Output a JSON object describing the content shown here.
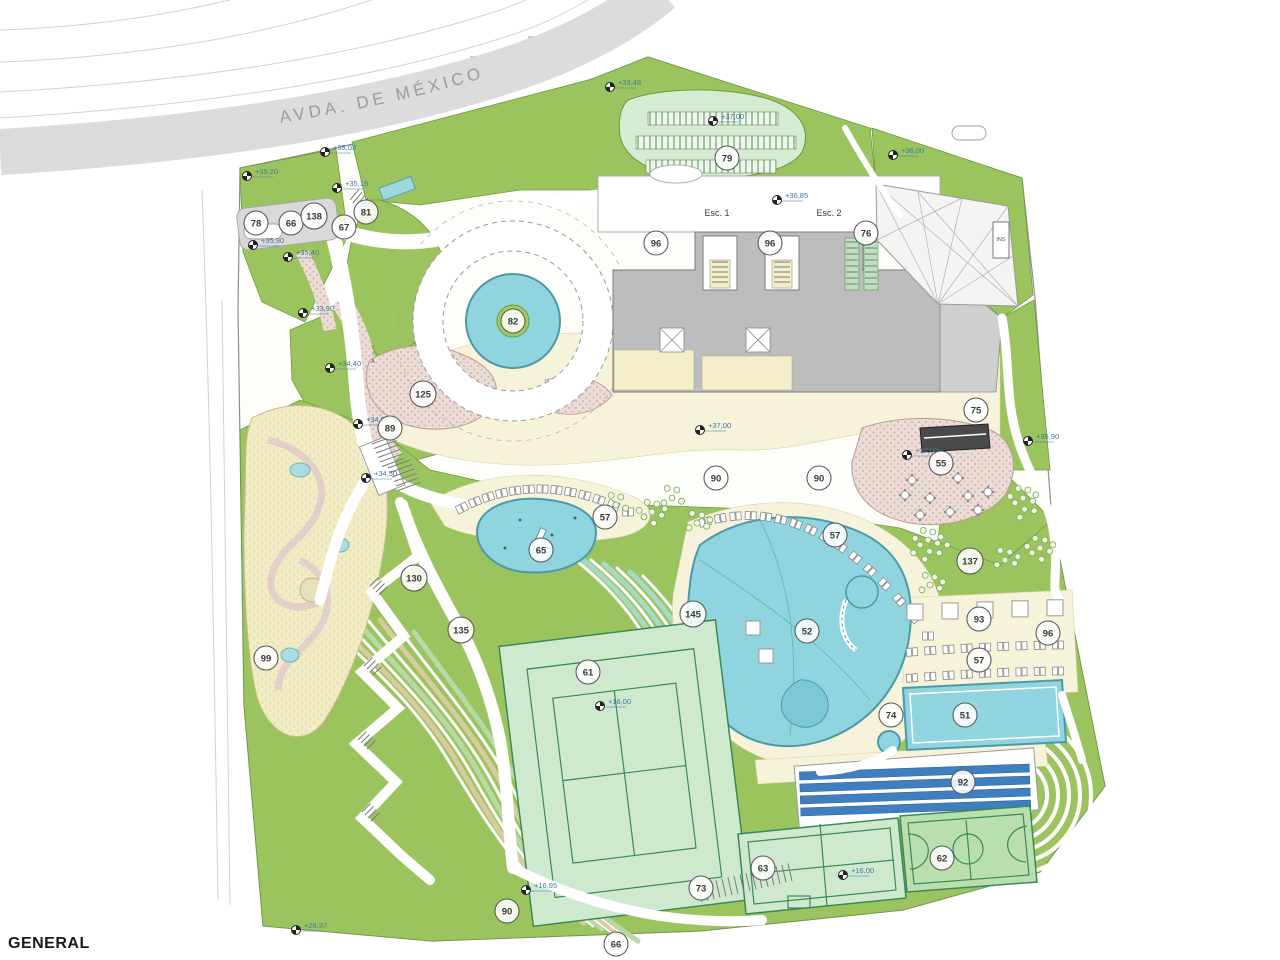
{
  "drawing": {
    "title": "GENERAL",
    "street_name": "AVDA. DE MÉXICO"
  },
  "colors": {
    "green": "#9cc45e",
    "mint": "#cfe9cf",
    "pool": "#8fd4de",
    "pool_edge": "#4a9aa8",
    "cream": "#f6f3da",
    "terrace_pink": "#ecdcd6",
    "sand": "#f1ecc3",
    "road": "#dcdcdc",
    "building": "#bdbdbd",
    "stand_blue": "#3f7fbf",
    "court_line": "#3a8a55",
    "elevation_ink": "#41789e"
  },
  "text_labels": [
    {
      "text": "Esc. 1",
      "x": 717,
      "y": 216,
      "vertical": false
    },
    {
      "text": "Esc. 2",
      "x": 829,
      "y": 216,
      "vertical": false
    },
    {
      "text": "INS",
      "x": 1001,
      "y": 241,
      "vertical": false,
      "small": true
    },
    {
      "text": "VIA",
      "x": 373,
      "y": 349,
      "vertical": true,
      "small": true
    }
  ],
  "zone_labels": [
    {
      "n": "78",
      "x": 256,
      "y": 223
    },
    {
      "n": "66",
      "x": 291,
      "y": 223
    },
    {
      "n": "138",
      "x": 314,
      "y": 216
    },
    {
      "n": "67",
      "x": 344,
      "y": 227
    },
    {
      "n": "81",
      "x": 366,
      "y": 212
    },
    {
      "n": "82",
      "x": 513,
      "y": 321
    },
    {
      "n": "125",
      "x": 423,
      "y": 394
    },
    {
      "n": "89",
      "x": 390,
      "y": 428
    },
    {
      "n": "79",
      "x": 727,
      "y": 158
    },
    {
      "n": "96",
      "x": 656,
      "y": 243
    },
    {
      "n": "96",
      "x": 770,
      "y": 243
    },
    {
      "n": "76",
      "x": 866,
      "y": 233
    },
    {
      "n": "75",
      "x": 976,
      "y": 410
    },
    {
      "n": "55",
      "x": 941,
      "y": 463
    },
    {
      "n": "90",
      "x": 716,
      "y": 478
    },
    {
      "n": "90",
      "x": 819,
      "y": 478
    },
    {
      "n": "57",
      "x": 605,
      "y": 517
    },
    {
      "n": "65",
      "x": 541,
      "y": 550
    },
    {
      "n": "57",
      "x": 835,
      "y": 535
    },
    {
      "n": "137",
      "x": 970,
      "y": 561
    },
    {
      "n": "52",
      "x": 807,
      "y": 631
    },
    {
      "n": "93",
      "x": 979,
      "y": 619
    },
    {
      "n": "57",
      "x": 979,
      "y": 660
    },
    {
      "n": "96",
      "x": 1048,
      "y": 633
    },
    {
      "n": "51",
      "x": 965,
      "y": 715
    },
    {
      "n": "74",
      "x": 891,
      "y": 715
    },
    {
      "n": "99",
      "x": 266,
      "y": 658
    },
    {
      "n": "130",
      "x": 414,
      "y": 578
    },
    {
      "n": "135",
      "x": 461,
      "y": 630
    },
    {
      "n": "145",
      "x": 693,
      "y": 614
    },
    {
      "n": "61",
      "x": 588,
      "y": 672
    },
    {
      "n": "92",
      "x": 963,
      "y": 782
    },
    {
      "n": "63",
      "x": 763,
      "y": 868
    },
    {
      "n": "62",
      "x": 942,
      "y": 858
    },
    {
      "n": "73",
      "x": 701,
      "y": 888
    },
    {
      "n": "90",
      "x": 507,
      "y": 911
    },
    {
      "n": "66",
      "x": 616,
      "y": 944
    }
  ],
  "elevation_markers": [
    {
      "v": "+35,03",
      "x": 325,
      "y": 152
    },
    {
      "v": "+35,20",
      "x": 247,
      "y": 176
    },
    {
      "v": "+35,15",
      "x": 337,
      "y": 188
    },
    {
      "v": "+35,90",
      "x": 253,
      "y": 245
    },
    {
      "v": "+35,40",
      "x": 288,
      "y": 257
    },
    {
      "v": "+33,90",
      "x": 303,
      "y": 313
    },
    {
      "v": "+34,40",
      "x": 330,
      "y": 368
    },
    {
      "v": "+34,90",
      "x": 358,
      "y": 424
    },
    {
      "v": "+34,50",
      "x": 366,
      "y": 478
    },
    {
      "v": "+33,48",
      "x": 610,
      "y": 87
    },
    {
      "v": "+37,00",
      "x": 713,
      "y": 121
    },
    {
      "v": "+36,85",
      "x": 777,
      "y": 200
    },
    {
      "v": "+36,00",
      "x": 893,
      "y": 155
    },
    {
      "v": "+37,00",
      "x": 700,
      "y": 430
    },
    {
      "v": "+37,00",
      "x": 907,
      "y": 455
    },
    {
      "v": "+36,90",
      "x": 1028,
      "y": 441
    },
    {
      "v": "+16,00",
      "x": 600,
      "y": 706
    },
    {
      "v": "+16,00",
      "x": 843,
      "y": 875
    },
    {
      "v": "+16,95",
      "x": 526,
      "y": 890
    },
    {
      "v": "+28,37",
      "x": 296,
      "y": 930
    }
  ]
}
